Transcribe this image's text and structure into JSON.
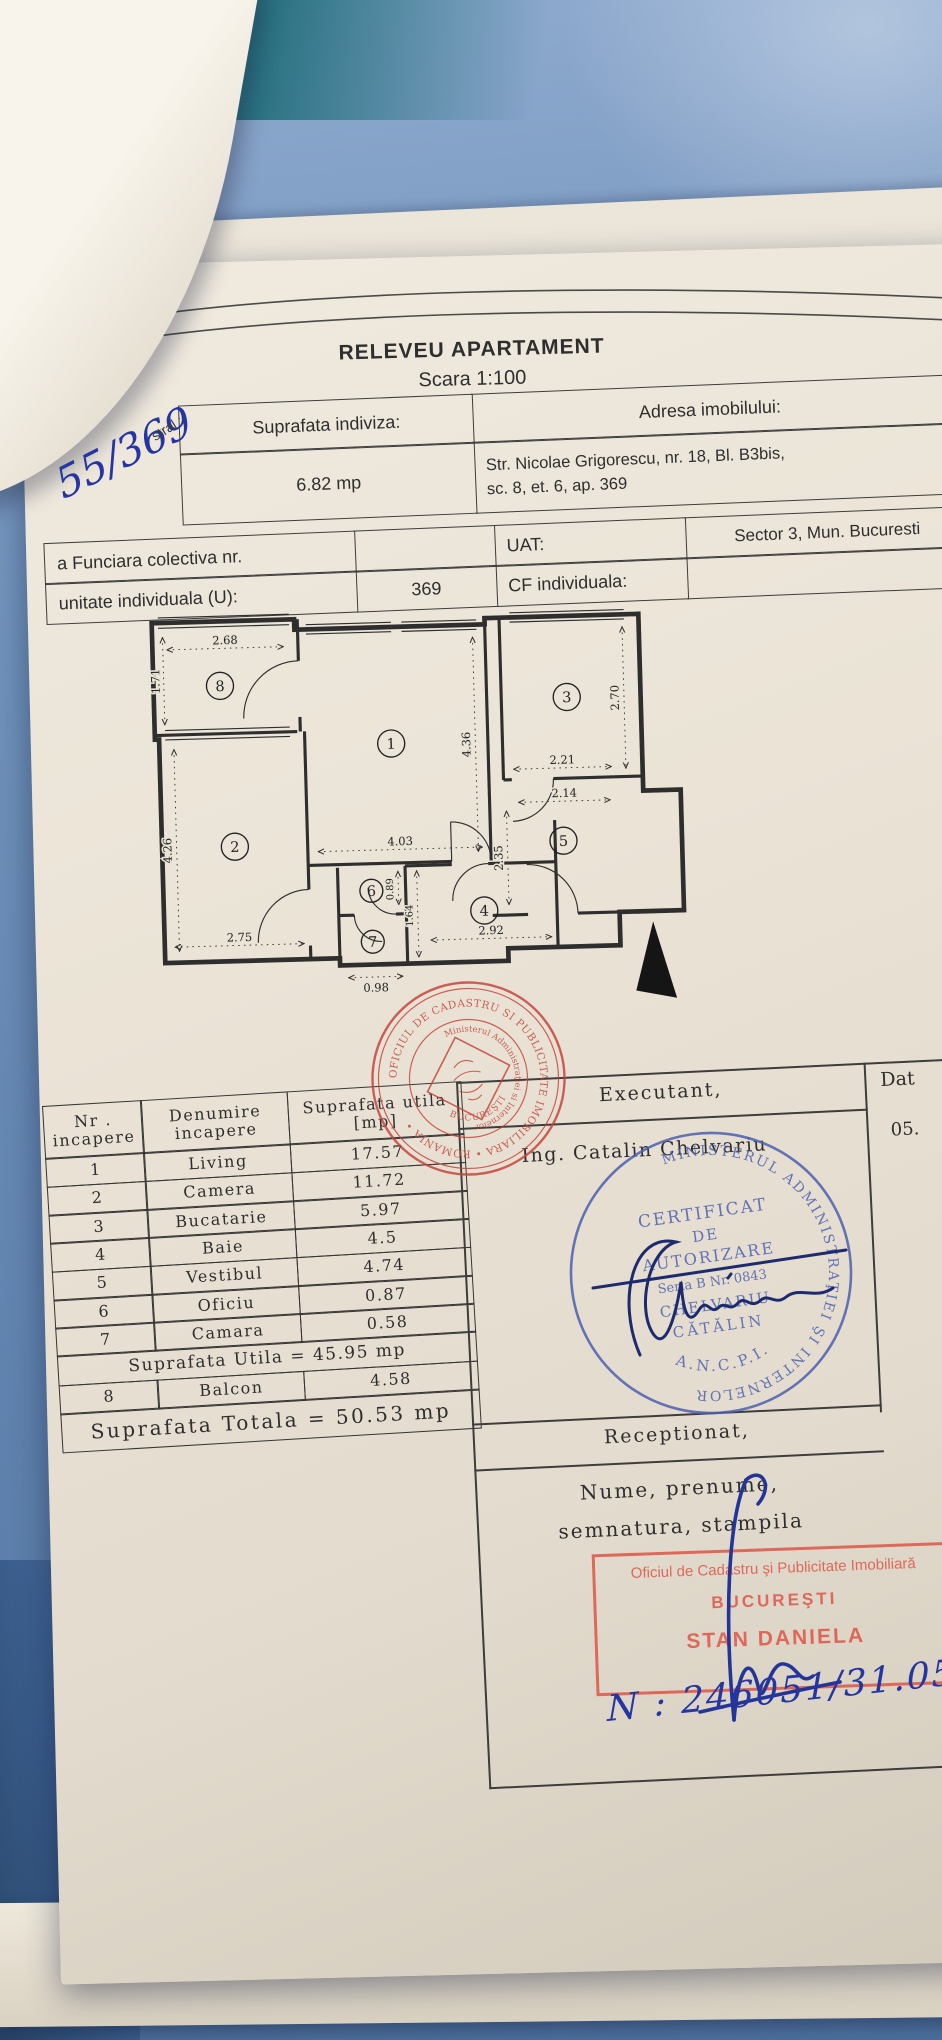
{
  "scene": {
    "paper_color": "#e9e3d6",
    "fabric_color": "#7193bc",
    "teal_color": "#26707f",
    "ink_blue": "#2535a2",
    "stamp_red": "#c34239",
    "rect_stamp_red": "#dd5648",
    "stamp_blue": "#4c60b0"
  },
  "title": {
    "line1": "RELEVEU APARTAMENT",
    "line2": "Scara 1:100"
  },
  "info_table": {
    "suprafata_label": "Suprafata indiviza:",
    "suprafata_value": "6.82 mp",
    "adresa_label": "Adresa imobilului:",
    "adresa_line1": "Str. Nicolae Grigorescu, nr. 18, Bl. B3bis,",
    "adresa_line2": "sc. 8, et. 6, ap. 369",
    "cadastral_partial": "stral :",
    "cf_colectiva_label": "a Funciara colectiva nr.",
    "uat_label": "UAT:",
    "uat_value": "Sector 3, Mun. Bucuresti",
    "unitate_label": "unitate individuala (U):",
    "unitate_value": "369",
    "cf_individuala_label": "CF individuala:"
  },
  "handwriting": {
    "cad_number": "55/369",
    "reg_number": "N : 246051/31.05"
  },
  "plan": {
    "rooms": {
      "r1": "1",
      "r2": "2",
      "r3": "3",
      "r4": "4",
      "r5": "5",
      "r6": "6",
      "r7": "7",
      "r8": "8"
    },
    "dims": {
      "balcon_w": "2.68",
      "balcon_h": "1.71",
      "living_h": "4.36",
      "living_w": "4.03",
      "bucatarie_h": "2.70",
      "bucatarie_w": "2.21",
      "hol_w": "2.14",
      "vestibul_h": "2.35",
      "camera_h": "4.26",
      "camera_w": "2.75",
      "oficiu_h": "0.89",
      "baie_h": "1.64",
      "camara_w": "0.98",
      "baie_w": "2.92"
    }
  },
  "rooms_table": {
    "header": {
      "col1_line1": "Nr .",
      "col1_line2": "incapere",
      "col2_line1": "Denumire",
      "col2_line2": "incapere",
      "col3_line1": "Suprafata utila",
      "col3_line2": "[mp]"
    },
    "rows": [
      {
        "nr": "1",
        "name": "Living",
        "area": "17.57"
      },
      {
        "nr": "2",
        "name": "Camera",
        "area": "11.72"
      },
      {
        "nr": "3",
        "name": "Bucatarie",
        "area": "5.97"
      },
      {
        "nr": "4",
        "name": "Baie",
        "area": "4.5"
      },
      {
        "nr": "5",
        "name": "Vestibul",
        "area": "4.74"
      },
      {
        "nr": "6",
        "name": "Oficiu",
        "area": "0.87"
      },
      {
        "nr": "7",
        "name": "Camara",
        "area": "0.58"
      }
    ],
    "utila_row": "Suprafata Utila = 45.95 mp",
    "balcon_row": {
      "nr": "8",
      "name": "Balcon",
      "area": "4.58"
    },
    "totala_row": "Suprafata Totala = 50.53 mp"
  },
  "executant": {
    "header": "Executant,",
    "name": "Ing. Catalin Chelvariu",
    "data_header": "Dat",
    "data_value": "05."
  },
  "blue_stamp": {
    "ring_text": "MINISTERUL ADMINISTRAŢIEI ŞI INTERNELOR",
    "bottom_text": "A.N.C.P.I.",
    "line1": "CERTIFICAT",
    "line2": "DE",
    "line3": "AUTORIZARE",
    "line4": "Seria B Nr. 0843",
    "line5": "CHELVARIU",
    "line6": "CĂTĂLIN"
  },
  "red_stamp": {
    "ring_text": "OFICIUL DE CADASTRU SI PUBLICITATE IMOBILIARA • ROMANIA •",
    "inner_ring_text": "Ministerul Administraţiei si Internelor",
    "inner_bottom_text": "BUCUREŞTI"
  },
  "receptionat": {
    "header": "Receptionat,",
    "line1": "Nume, prenume,",
    "line2": "semnatura, stampila"
  },
  "rect_stamp": {
    "line1": "Oficiul de Cadastru şi Publicitate Imobiliară",
    "line2": "BUCUREŞTI",
    "line3": "STAN DANIELA"
  }
}
